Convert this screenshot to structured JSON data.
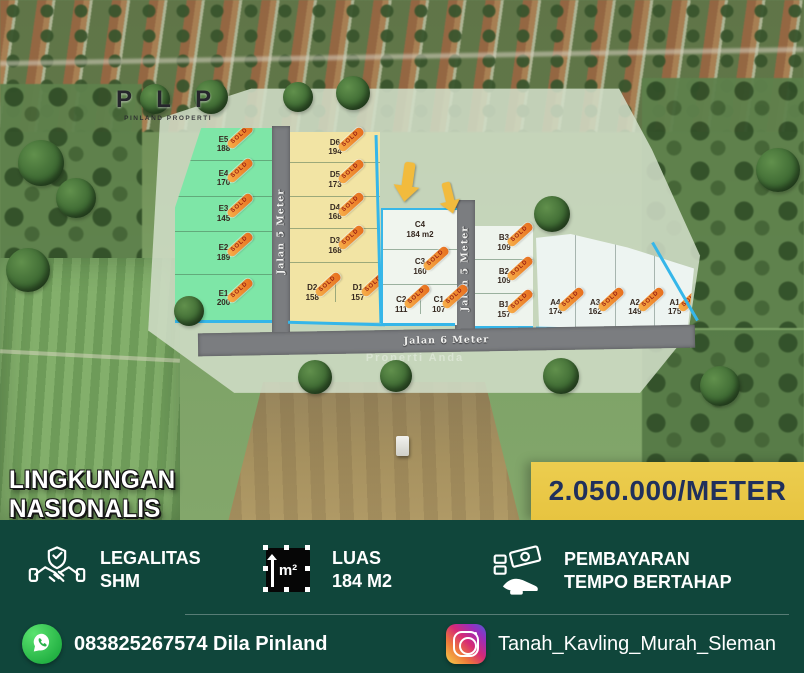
{
  "logo": {
    "title": "P L P",
    "subtitle": "PINLAND PROPERTI"
  },
  "plan": {
    "roads": {
      "v1": "Jalan 5 Meter",
      "v2": "Jalan 5 Meter",
      "h": "Jalan 6 Meter"
    },
    "watermark": "Properti Anda"
  },
  "labels": {
    "sold": "SOLD"
  },
  "plots": {
    "E5": {
      "id": "E5",
      "area": "188",
      "status": "sold"
    },
    "E4": {
      "id": "E4",
      "area": "170",
      "status": "sold"
    },
    "E3": {
      "id": "E3",
      "area": "145",
      "status": "sold"
    },
    "E2": {
      "id": "E2",
      "area": "189",
      "status": "sold"
    },
    "E1": {
      "id": "E1",
      "area": "200",
      "status": "sold"
    },
    "D6": {
      "id": "D6",
      "area": "194",
      "status": "sold"
    },
    "D5": {
      "id": "D5",
      "area": "173",
      "status": "sold"
    },
    "D4": {
      "id": "D4",
      "area": "168",
      "status": "sold"
    },
    "D3": {
      "id": "D3",
      "area": "168",
      "status": "sold"
    },
    "D2": {
      "id": "D2",
      "area": "158",
      "status": "sold"
    },
    "D1": {
      "id": "D1",
      "area": "157",
      "status": "sold"
    },
    "C4": {
      "id": "C4",
      "area": "184 m2",
      "status": "available"
    },
    "C3": {
      "id": "C3",
      "area": "160",
      "status": "sold"
    },
    "C2": {
      "id": "C2",
      "area": "111",
      "status": "sold"
    },
    "C1": {
      "id": "C1",
      "area": "107",
      "status": "sold"
    },
    "B3": {
      "id": "B3",
      "area": "109",
      "status": "sold"
    },
    "B2": {
      "id": "B2",
      "area": "109",
      "status": "sold"
    },
    "B1": {
      "id": "B1",
      "area": "157",
      "status": "sold"
    },
    "A4": {
      "id": "A4",
      "area": "174",
      "status": "sold"
    },
    "A3": {
      "id": "A3",
      "area": "162",
      "status": "sold"
    },
    "A2": {
      "id": "A2",
      "area": "149",
      "status": "sold"
    },
    "A1": {
      "id": "A1",
      "area": "175",
      "status": "sold"
    }
  },
  "banner": {
    "headline": "LINGKUNGAN NASIONALIS",
    "price": "2.050.000/METER"
  },
  "features": [
    {
      "icon": "handshake-icon",
      "line1": "LEGALITAS",
      "line2": "SHM"
    },
    {
      "icon": "area-icon",
      "glyph": "m²",
      "line1": "LUAS",
      "line2": "184 M2"
    },
    {
      "icon": "installment-icon",
      "line1": "PEMBAYARAN",
      "line2": "TEMPO BERTAHAP"
    }
  ],
  "contacts": {
    "whatsapp": "083825267574 Dila Pinland",
    "instagram": "Tanah_Kavling_Murah_Sleman"
  },
  "colors": {
    "footer_green": "#10463b",
    "price_bg": "#e9c947",
    "price_text": "#20305c",
    "plot_green": "#7ee6a7",
    "plot_yellow": "#f2e4a4",
    "plot_white": "#f0f5ee",
    "road_gray": "#7b7d80",
    "border_blue": "#35b6e9",
    "sold_orange": "#ef8a2c",
    "arrow_yellow": "#f2bb3d"
  }
}
